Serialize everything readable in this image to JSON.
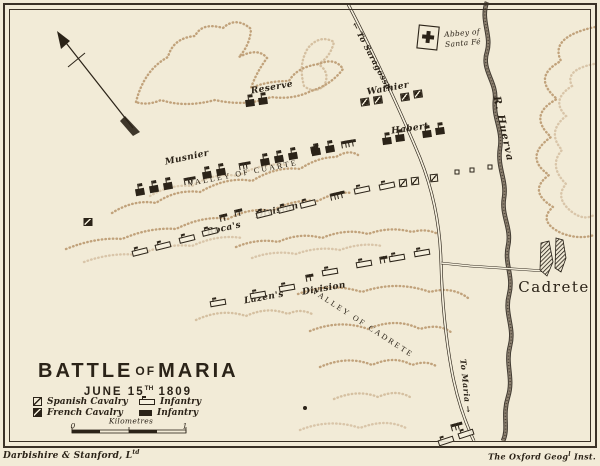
{
  "title": {
    "main_1": "BATTLE",
    "main_of": "OF",
    "main_2": "MARIA",
    "date_pre": "JUNE 15",
    "date_sup": "TH",
    "date_post": "1809"
  },
  "legend": {
    "items": [
      {
        "id": "spanish-cavalry",
        "label": "Spanish Cavalry"
      },
      {
        "id": "french-cavalry",
        "label": "French Cavalry"
      },
      {
        "id": "infantry-open",
        "label": "Infantry"
      },
      {
        "id": "infantry-solid",
        "label": "Infantry"
      }
    ],
    "scale": {
      "label": "Kilometres",
      "start": "0",
      "end": "1"
    }
  },
  "imprints": {
    "left_main": "Darbishire & Stanford, L",
    "left_sup": "td",
    "right_pre": "The Oxford Geog",
    "right_sup": "l",
    "right_post": " Inst."
  },
  "map": {
    "colors": {
      "ink": "#2b2318",
      "paper": "#f2ebd7",
      "terrain": "#b08a5d",
      "river": "#2f2820"
    },
    "labels": [
      {
        "id": "reserve",
        "text": "Reserve",
        "x": 272,
        "y": 88,
        "rot": -10,
        "kind": "hand"
      },
      {
        "id": "musnier",
        "text": "Musnier",
        "x": 187,
        "y": 158,
        "rot": -12,
        "kind": "hand"
      },
      {
        "id": "wathier",
        "text": "Wathier",
        "x": 388,
        "y": 89,
        "rot": -10,
        "kind": "hand"
      },
      {
        "id": "habert",
        "text": "Habert",
        "x": 410,
        "y": 129,
        "rot": -8,
        "kind": "hand"
      },
      {
        "id": "rocas",
        "text": "Roca's",
        "x": 224,
        "y": 229,
        "rot": -13,
        "kind": "hand"
      },
      {
        "id": "rocas-division",
        "text": "Division",
        "x": 277,
        "y": 211,
        "rot": -13,
        "kind": "hand"
      },
      {
        "id": "lazens",
        "text": "Lazen's",
        "x": 264,
        "y": 298,
        "rot": -10,
        "kind": "hand"
      },
      {
        "id": "lazens-division",
        "text": "Division",
        "x": 324,
        "y": 289,
        "rot": -10,
        "kind": "hand"
      },
      {
        "id": "valley-of-cuarte",
        "text": "VALLEY OF CUARTE",
        "x": 243,
        "y": 173,
        "rot": -11,
        "kind": "valley"
      },
      {
        "id": "valley-of-cadrete",
        "text": "VALLEY OF CADRETE",
        "x": 363,
        "y": 323,
        "rot": 33,
        "kind": "valley"
      },
      {
        "id": "cadrete",
        "text": "Cadrete",
        "x": 554,
        "y": 287,
        "rot": 0,
        "kind": "town"
      },
      {
        "id": "r-huerva",
        "text": "R. Huerva",
        "x": 503,
        "y": 129,
        "rot": 78,
        "kind": "river"
      },
      {
        "id": "to-saragossa",
        "text": "← To Saragossa",
        "x": 372,
        "y": 56,
        "rot": 62,
        "kind": "road"
      },
      {
        "id": "to-maria",
        "text": "To Maria →",
        "x": 466,
        "y": 386,
        "rot": 84,
        "kind": "road"
      },
      {
        "id": "abbey-line1",
        "text": "Abbey of",
        "x": 462,
        "y": 33,
        "rot": -5,
        "kind": "hand-sm"
      },
      {
        "id": "abbey-line2",
        "text": "Santa Fé",
        "x": 463,
        "y": 43,
        "rot": -5,
        "kind": "hand-sm"
      },
      {
        "id": "scale-kilometres",
        "text": "Kilometres",
        "x": 131,
        "y": 421,
        "rot": 0,
        "kind": "hand-sm"
      },
      {
        "id": "scale-0",
        "text": "0",
        "x": 73,
        "y": 426,
        "rot": 0,
        "kind": "hand-sm"
      },
      {
        "id": "scale-1",
        "text": "1",
        "x": 185,
        "y": 426,
        "rot": 0,
        "kind": "hand-sm"
      }
    ],
    "units": [
      {
        "t": "fi",
        "x": 250,
        "y": 103,
        "r": -8
      },
      {
        "t": "fi",
        "x": 263,
        "y": 101,
        "r": -8
      },
      {
        "t": "fi",
        "x": 140,
        "y": 192,
        "r": -10
      },
      {
        "t": "fi",
        "x": 154,
        "y": 189,
        "r": -10
      },
      {
        "t": "fi",
        "x": 168,
        "y": 186,
        "r": -10
      },
      {
        "t": "fi",
        "x": 207,
        "y": 175,
        "r": -10
      },
      {
        "t": "fi",
        "x": 221,
        "y": 172,
        "r": -10
      },
      {
        "t": "fi",
        "x": 265,
        "y": 162,
        "r": -10
      },
      {
        "t": "fi",
        "x": 279,
        "y": 159,
        "r": -10
      },
      {
        "t": "fi",
        "x": 293,
        "y": 156,
        "r": -10
      },
      {
        "t": "fi",
        "x": 316,
        "y": 152,
        "r": -10
      },
      {
        "t": "fi",
        "x": 330,
        "y": 149,
        "r": -10
      },
      {
        "t": "fi",
        "x": 387,
        "y": 141,
        "r": -8
      },
      {
        "t": "fi",
        "x": 400,
        "y": 138,
        "r": -8
      },
      {
        "t": "fi",
        "x": 427,
        "y": 134,
        "r": -8
      },
      {
        "t": "fi",
        "x": 440,
        "y": 131,
        "r": -8
      },
      {
        "t": "fc",
        "x": 365,
        "y": 102,
        "r": -8
      },
      {
        "t": "fc",
        "x": 378,
        "y": 100,
        "r": -8
      },
      {
        "t": "fc",
        "x": 405,
        "y": 97,
        "r": -8
      },
      {
        "t": "fc",
        "x": 418,
        "y": 94,
        "r": -8
      },
      {
        "t": "fc",
        "x": 88,
        "y": 222,
        "r": 0
      },
      {
        "t": "sc",
        "x": 403,
        "y": 183,
        "r": -5
      },
      {
        "t": "sc",
        "x": 415,
        "y": 181,
        "r": -5
      },
      {
        "t": "sc",
        "x": 434,
        "y": 178,
        "r": -5
      },
      {
        "t": "si",
        "x": 140,
        "y": 252,
        "r": -14
      },
      {
        "t": "si",
        "x": 163,
        "y": 246,
        "r": -14
      },
      {
        "t": "si",
        "x": 187,
        "y": 239,
        "r": -14
      },
      {
        "t": "si",
        "x": 210,
        "y": 232,
        "r": -14
      },
      {
        "t": "si",
        "x": 264,
        "y": 214,
        "r": -14
      },
      {
        "t": "si",
        "x": 286,
        "y": 209,
        "r": -14
      },
      {
        "t": "si",
        "x": 308,
        "y": 204,
        "r": -14
      },
      {
        "t": "si",
        "x": 362,
        "y": 190,
        "r": -12
      },
      {
        "t": "si",
        "x": 387,
        "y": 186,
        "r": -12
      },
      {
        "t": "si",
        "x": 218,
        "y": 303,
        "r": -10
      },
      {
        "t": "si",
        "x": 258,
        "y": 295,
        "r": -10
      },
      {
        "t": "si",
        "x": 287,
        "y": 288,
        "r": -10
      },
      {
        "t": "si",
        "x": 330,
        "y": 272,
        "r": -10
      },
      {
        "t": "si",
        "x": 364,
        "y": 264,
        "r": -10
      },
      {
        "t": "si",
        "x": 397,
        "y": 258,
        "r": -10
      },
      {
        "t": "si",
        "x": 422,
        "y": 253,
        "r": -10
      },
      {
        "t": "si",
        "x": 446,
        "y": 441,
        "r": -18
      },
      {
        "t": "si",
        "x": 466,
        "y": 434,
        "r": -18
      },
      {
        "t": "so",
        "x": 457,
        "y": 172,
        "r": 0
      },
      {
        "t": "so",
        "x": 472,
        "y": 170,
        "r": 0
      },
      {
        "t": "so",
        "x": 490,
        "y": 167,
        "r": 0
      },
      {
        "t": "dot",
        "x": 305,
        "y": 408,
        "r": 0
      }
    ],
    "flag_clusters": [
      {
        "x": 188,
        "y": 181,
        "n": 3,
        "r": -10
      },
      {
        "x": 243,
        "y": 166,
        "n": 3,
        "r": -10
      },
      {
        "x": 313,
        "y": 150,
        "n": 2,
        "r": -10
      },
      {
        "x": 347,
        "y": 144,
        "n": 4,
        "r": -10
      },
      {
        "x": 222,
        "y": 218,
        "n": 2,
        "r": -13
      },
      {
        "x": 237,
        "y": 213,
        "n": 2,
        "r": -13
      },
      {
        "x": 336,
        "y": 196,
        "n": 4,
        "r": -13
      },
      {
        "x": 308,
        "y": 278,
        "n": 2,
        "r": -10
      },
      {
        "x": 382,
        "y": 260,
        "n": 2,
        "r": -10
      },
      {
        "x": 455,
        "y": 427,
        "n": 3,
        "r": -15
      }
    ]
  }
}
